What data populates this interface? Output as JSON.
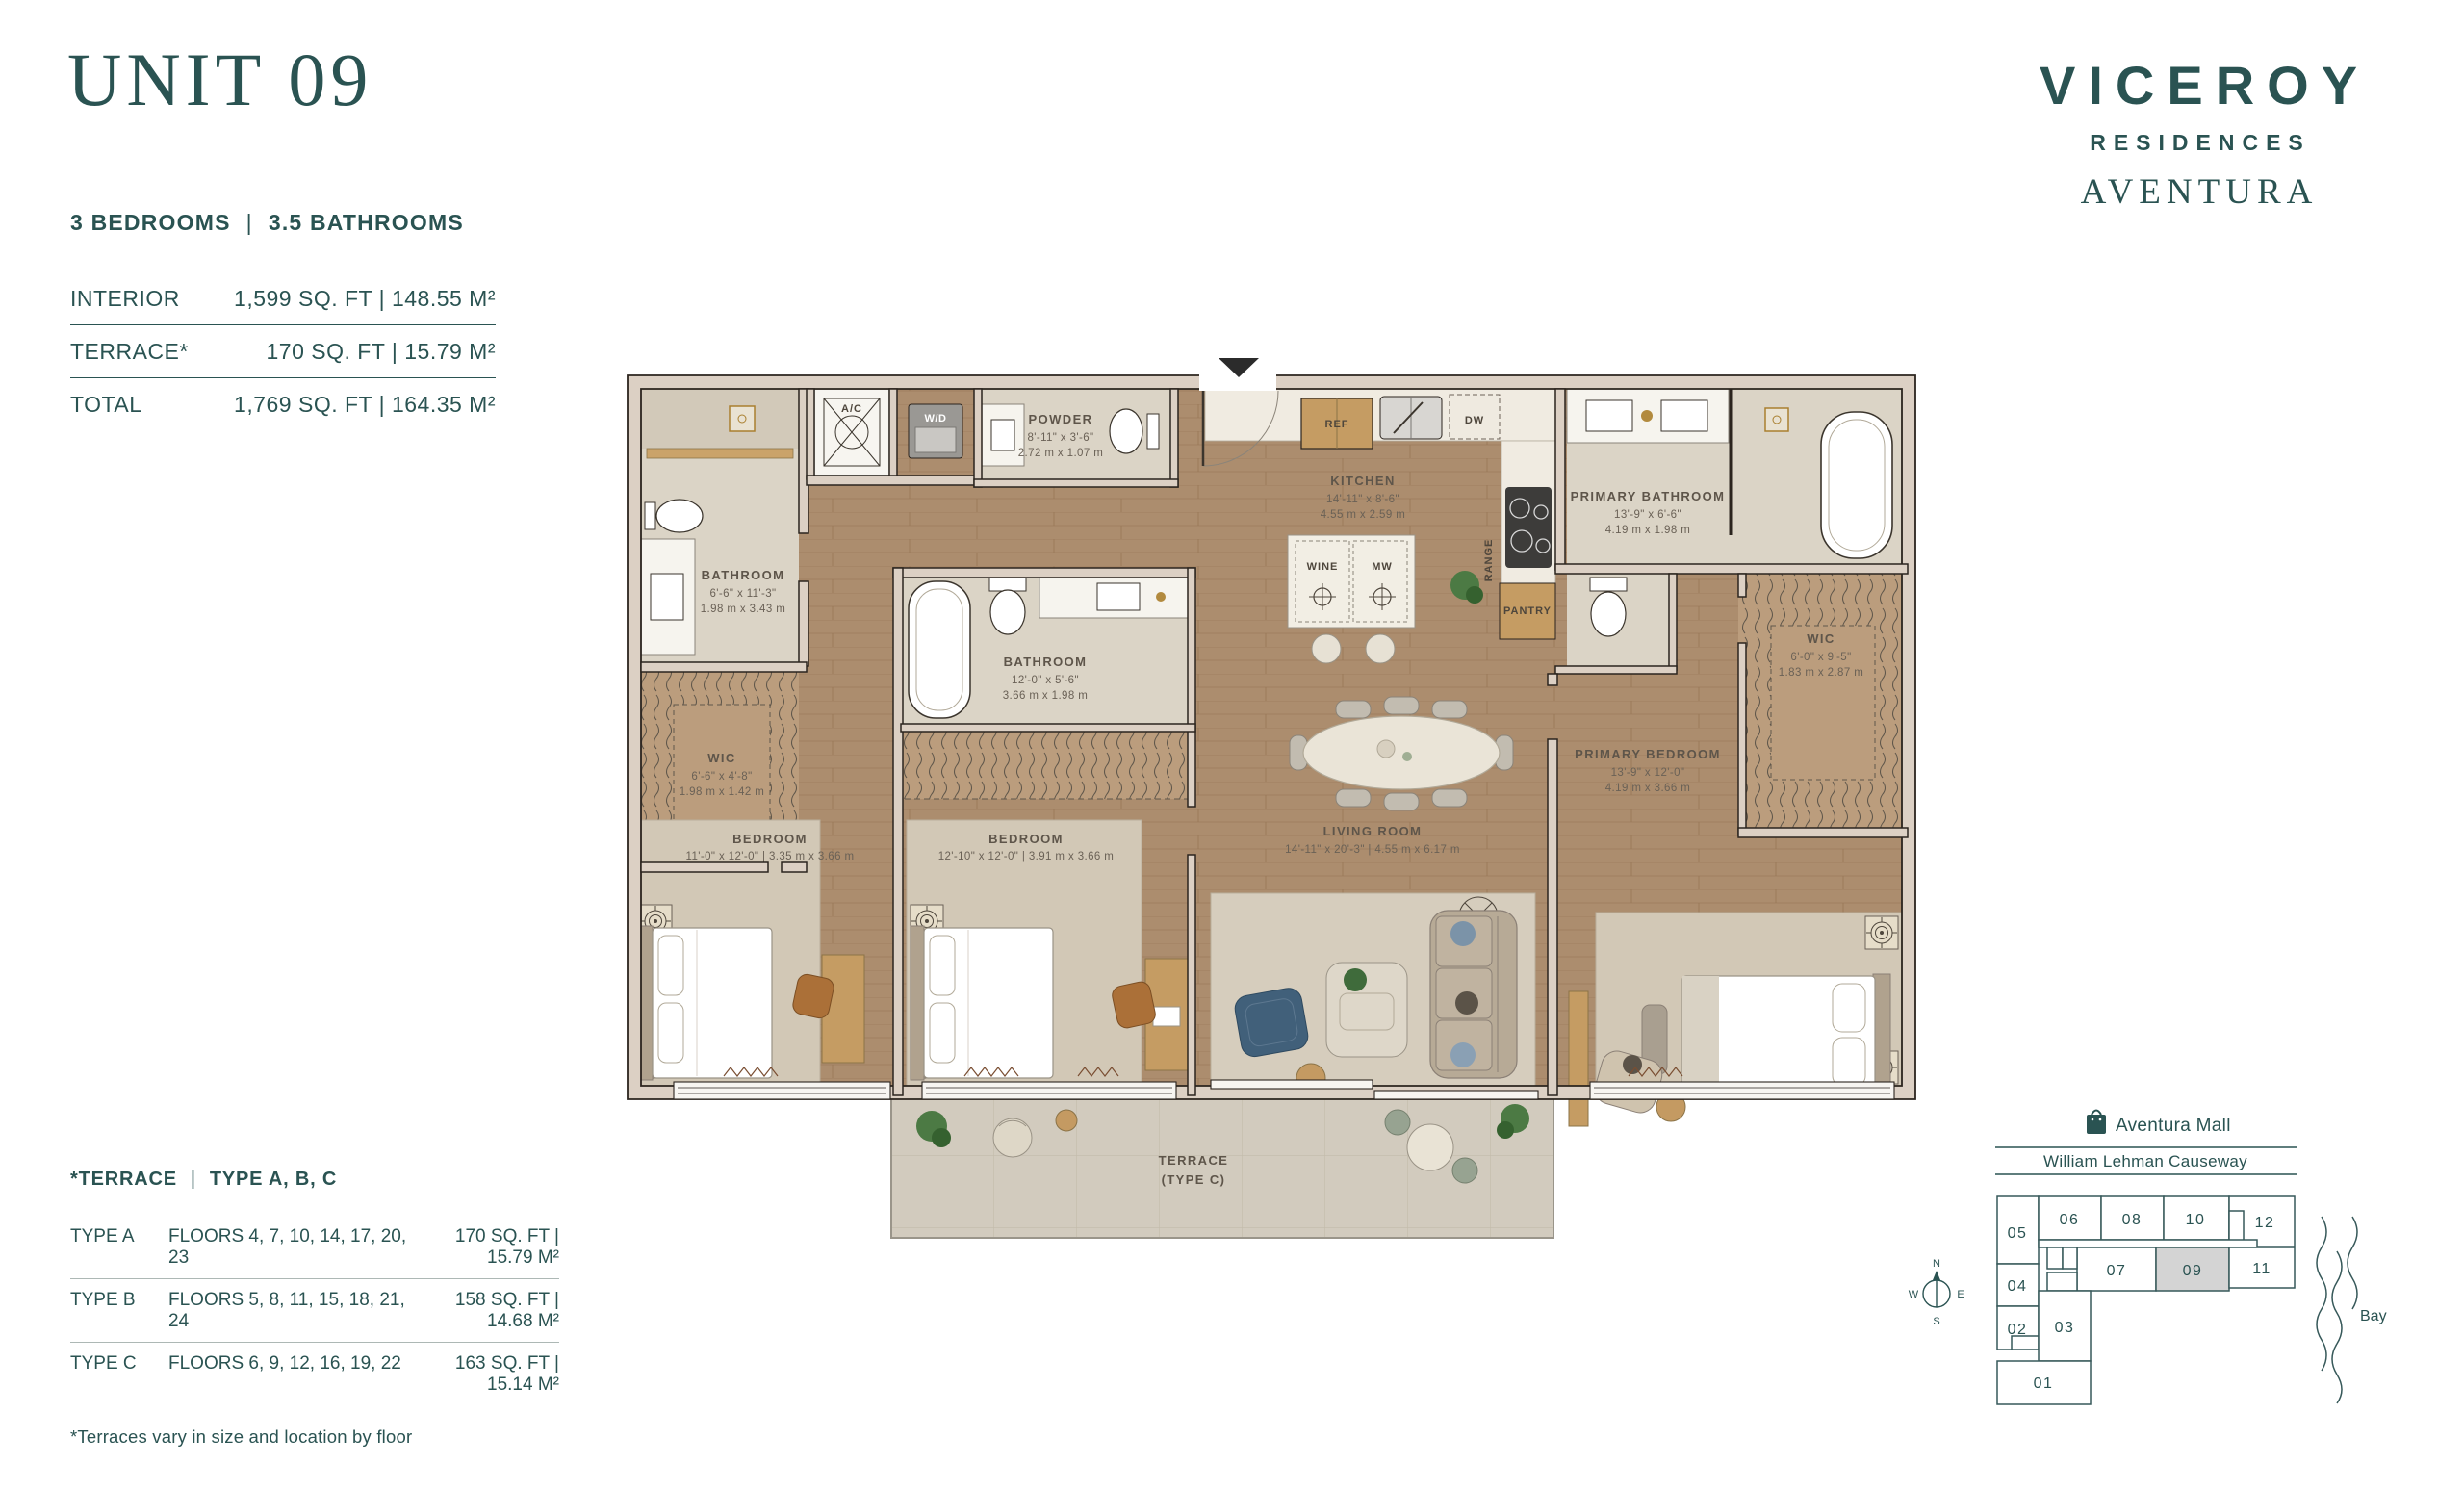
{
  "header": {
    "title": "UNIT 09",
    "bedrooms": "3 BEDROOMS",
    "divider": "|",
    "bathrooms": "3.5 BATHROOMS"
  },
  "area_table": {
    "rows": [
      {
        "label": "INTERIOR",
        "value": "1,599 SQ. FT | 148.55 M²"
      },
      {
        "label": "TERRACE*",
        "value": "170 SQ. FT | 15.79 M²"
      },
      {
        "label": "TOTAL",
        "value": "1,769 SQ. FT | 164.35 M²"
      }
    ]
  },
  "brand": {
    "name": "VICEROY",
    "residences": "RESIDENCES",
    "location": "AVENTURA"
  },
  "plan": {
    "rooms": {
      "bath1": {
        "name": "BATHROOM",
        "ft": "6'-6\" x 11'-3\"",
        "m": "1.98 m x 3.43 m"
      },
      "wic1": {
        "name": "WIC",
        "ft": "6'-6\" x 4'-8\"",
        "m": "1.98 m x 1.42 m"
      },
      "powder": {
        "name": "POWDER",
        "ft": "8'-11\" x 3'-6\"",
        "m": "2.72 m x 1.07 m"
      },
      "bath2": {
        "name": "BATHROOM",
        "ft": "12'-0\" x 5'-6\"",
        "m": "3.66 m x 1.98 m"
      },
      "kitchen": {
        "name": "KITCHEN",
        "ft": "14'-11\" x 8'-6\"",
        "m": "4.55 m x 2.59 m"
      },
      "living": {
        "name": "LIVING ROOM",
        "dims": "14'-11\" x 20'-3\" | 4.55 m x 6.17 m"
      },
      "bedroom1": {
        "name": "BEDROOM",
        "dims": "11'-0\" x 12'-0\" | 3.35 m x 3.66 m"
      },
      "bedroom2": {
        "name": "BEDROOM",
        "dims": "12'-10\" x 12'-0\" | 3.91 m x 3.66 m"
      },
      "primary_bath": {
        "name": "PRIMARY BATHROOM",
        "ft": "13'-9\" x 6'-6\"",
        "m": "4.19 m x 1.98 m"
      },
      "wic2": {
        "name": "WIC",
        "ft": "6'-0\" x 9'-5\"",
        "m": "1.83 m x 2.87 m"
      },
      "primary_bedroom": {
        "name": "PRIMARY BEDROOM",
        "ft": "13'-9\" x 12'-0\"",
        "m": "4.19 m x 3.66 m"
      },
      "terrace": {
        "name": "TERRACE",
        "type": "(TYPE C)"
      }
    },
    "appliances": {
      "ac": "A/C",
      "wd": "W/D",
      "ref": "REF",
      "dw": "DW",
      "range": "RANGE",
      "pantry": "PANTRY",
      "wine": "WINE",
      "mw": "MW"
    }
  },
  "terrace_table": {
    "title_label": "*TERRACE",
    "title_divider": "|",
    "title_types": "TYPE A, B, C",
    "rows": [
      {
        "type": "TYPE A",
        "floors": "FLOORS  4, 7, 10, 14, 17, 20, 23",
        "area": "170 SQ. FT | 15.79 M²"
      },
      {
        "type": "TYPE B",
        "floors": "FLOORS  5, 8, 11, 15, 18, 21, 24",
        "area": "158 SQ. FT | 14.68 M²"
      },
      {
        "type": "TYPE C",
        "floors": "FLOORS  6, 9, 12, 16, 19, 22",
        "area": "163 SQ. FT | 15.14 M²"
      }
    ],
    "footnote": "*Terraces vary in size and location by floor"
  },
  "keyplan": {
    "mall": "Aventura Mall",
    "causeway": "William Lehman Causeway",
    "bay": "Bay",
    "units": [
      "01",
      "02",
      "03",
      "04",
      "05",
      "06",
      "07",
      "08",
      "09",
      "10",
      "11",
      "12"
    ],
    "highlighted_unit": "09",
    "highlight_color": "#d4d4d4",
    "compass": {
      "n": "N",
      "e": "E",
      "s": "S",
      "w": "W"
    }
  },
  "colors": {
    "accent": "#2a5352"
  }
}
